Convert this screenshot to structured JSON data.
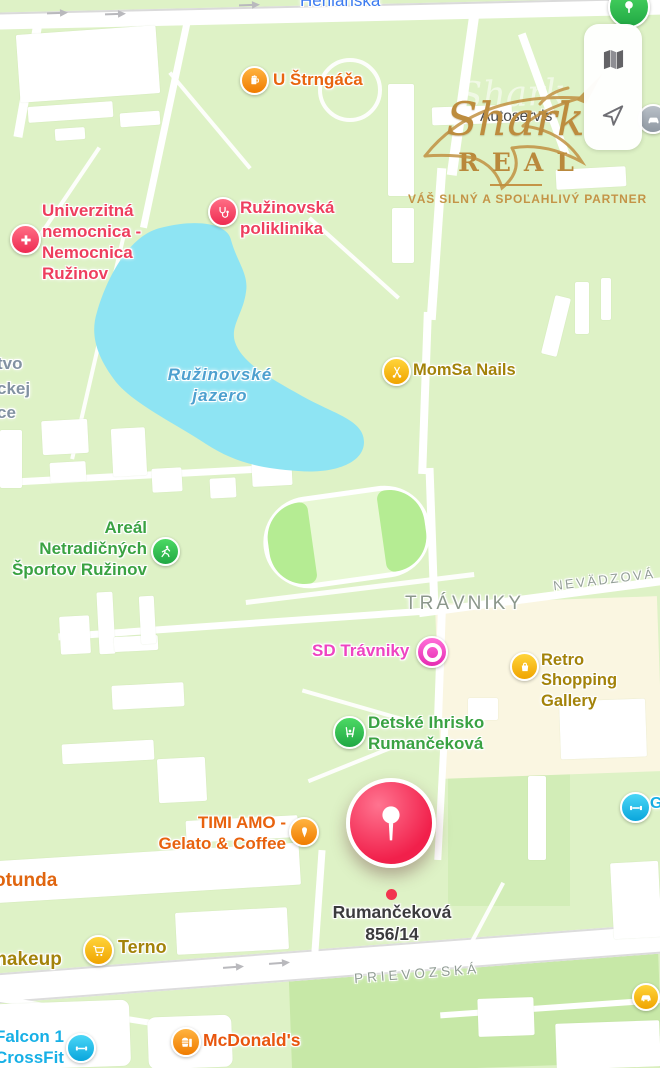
{
  "controls": {
    "map_mode_icon": "folded-map",
    "locate_icon": "location-arrow"
  },
  "watermark": {
    "ghost_script": "Shark",
    "script": "Shark",
    "brand": "REAL",
    "tagline": "VÁŠ SILNÝ A SPOĽAHLIVÝ PARTNER"
  },
  "selection": {
    "address": "Rumančeková\n856/14"
  },
  "water": {
    "lake": "Ružinovské\njazero"
  },
  "streets": {
    "herlianska": "Herlianska",
    "nevadzova": "NEVÄDZOVÁ",
    "travniky_district": "TRÁVNIKY",
    "prievozska": "PRIEVOZSKÁ",
    "left_cropped": "tvo\nckej\nce",
    "right_cropped_gym": "G"
  },
  "pois": {
    "u_strngaca": {
      "label": "U Štrngáča",
      "icon": "beer-mug",
      "color": "#e8650f"
    },
    "autoservis": {
      "label": "Autoservis",
      "icon": "car-service",
      "color": "#4b4b4d"
    },
    "hospital": {
      "label": "Univerzitná\nnemocnica -\nNemocnica\nRužinov",
      "icon": "medical-cross",
      "color": "#ee3e5e"
    },
    "poliklinika": {
      "label": "Ružinovská\npoliklinika",
      "icon": "stethoscope",
      "color": "#ee3e5e"
    },
    "momsa_nails": {
      "label": "MomSa Nails",
      "icon": "scissors",
      "color": "#a3830a"
    },
    "areal_sportov": {
      "label": "Areál\nNetradičných\nŠportov Ružinov",
      "icon": "runner",
      "color": "#3aa242"
    },
    "sd_travniky": {
      "label": "SD Trávniky",
      "icon": "ring",
      "color": "#ee44c2"
    },
    "retro_gallery": {
      "label": "Retro Shopping\nGallery",
      "icon": "shopping-bag",
      "color": "#a3830a"
    },
    "detske_ihrisko": {
      "label": "Detské Ihrisko\nRumančeková",
      "icon": "playground-swing",
      "color": "#3aa242"
    },
    "timi_amo": {
      "label": "TIMI AMO -\nGelato & Coffee",
      "icon": "ice-cream",
      "color": "#e8620e"
    },
    "rotunda": {
      "label": "otunda",
      "color": "#e0650f"
    },
    "makeup": {
      "label": "makeup",
      "color": "#a3830a"
    },
    "terno": {
      "label": "Terno",
      "icon": "shopping-cart",
      "color": "#a3830a"
    },
    "falcon_crossfit": {
      "label": "Falcon 1\nCrossFit",
      "icon": "dumbbell",
      "color": "#17b0e6"
    },
    "mcdonalds": {
      "label": "McDonald's",
      "icon": "fast-food",
      "color": "#e8560e"
    },
    "gym_right": {
      "icon": "dumbbell",
      "color": "#17b0e6"
    },
    "car_poi": {
      "icon": "car",
      "color": "#f2b300"
    },
    "park_poi": {
      "icon": "tree",
      "color": "#2fc161"
    }
  }
}
